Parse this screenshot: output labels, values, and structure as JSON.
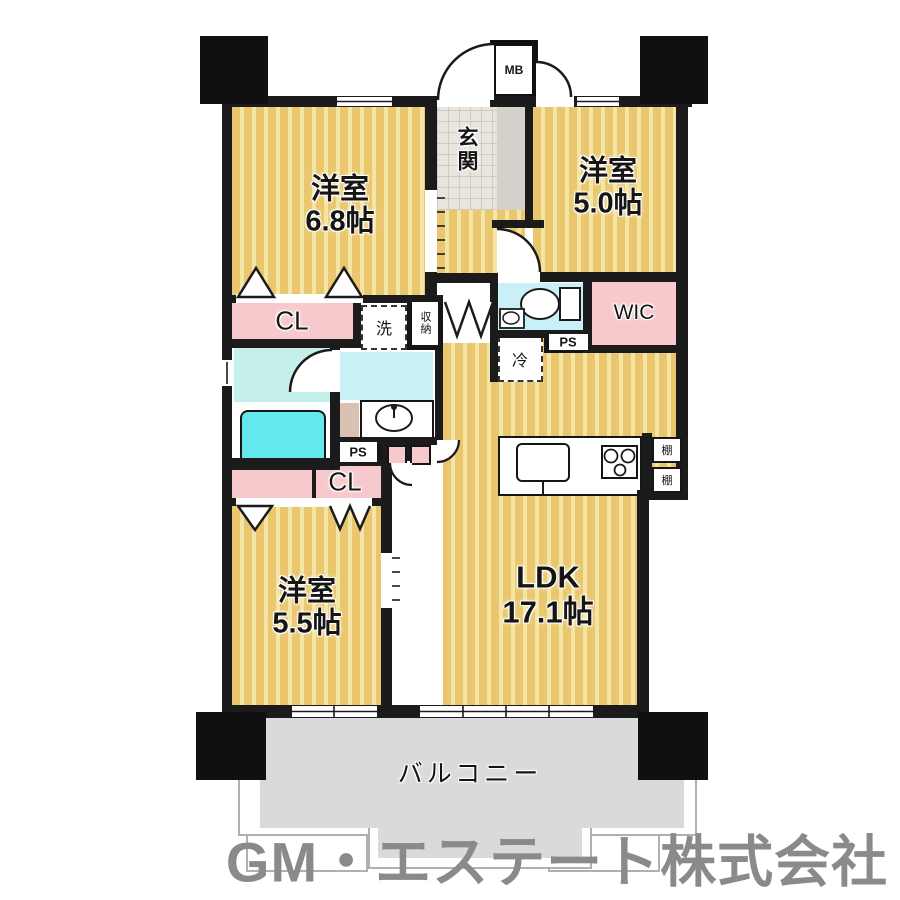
{
  "floorplan": {
    "watermark": "GM・エステート株式会社",
    "rooms": {
      "bedroom1": {
        "name": "洋室",
        "size": "6.8帖"
      },
      "bedroom2": {
        "name": "洋室",
        "size": "5.0帖"
      },
      "bedroom3": {
        "name": "洋室",
        "size": "5.5帖"
      },
      "ldk": {
        "name": "LDK",
        "size": "17.1帖"
      },
      "entrance": {
        "name": "玄関"
      },
      "balcony": {
        "name": "バルコニー"
      }
    },
    "labels": {
      "closet1": "CL",
      "closet2": "CL",
      "wic": "WIC",
      "ps1": "PS",
      "ps2": "PS",
      "mb": "MB",
      "laundry": "洗",
      "storage": "収納",
      "fridge": "冷",
      "shelf1": "棚",
      "shelf2": "棚"
    },
    "colors": {
      "wall": "#1b1b1b",
      "flooring": "#eac76f",
      "flooring_stripe": "#f5e5a4",
      "wet_area": "#c9f2f4",
      "bathtub": "#63e8ee",
      "closet_pink": "#f7c9cd",
      "balcony_floor": "#dadada",
      "watermark_gray": "#8a8a8a"
    }
  }
}
